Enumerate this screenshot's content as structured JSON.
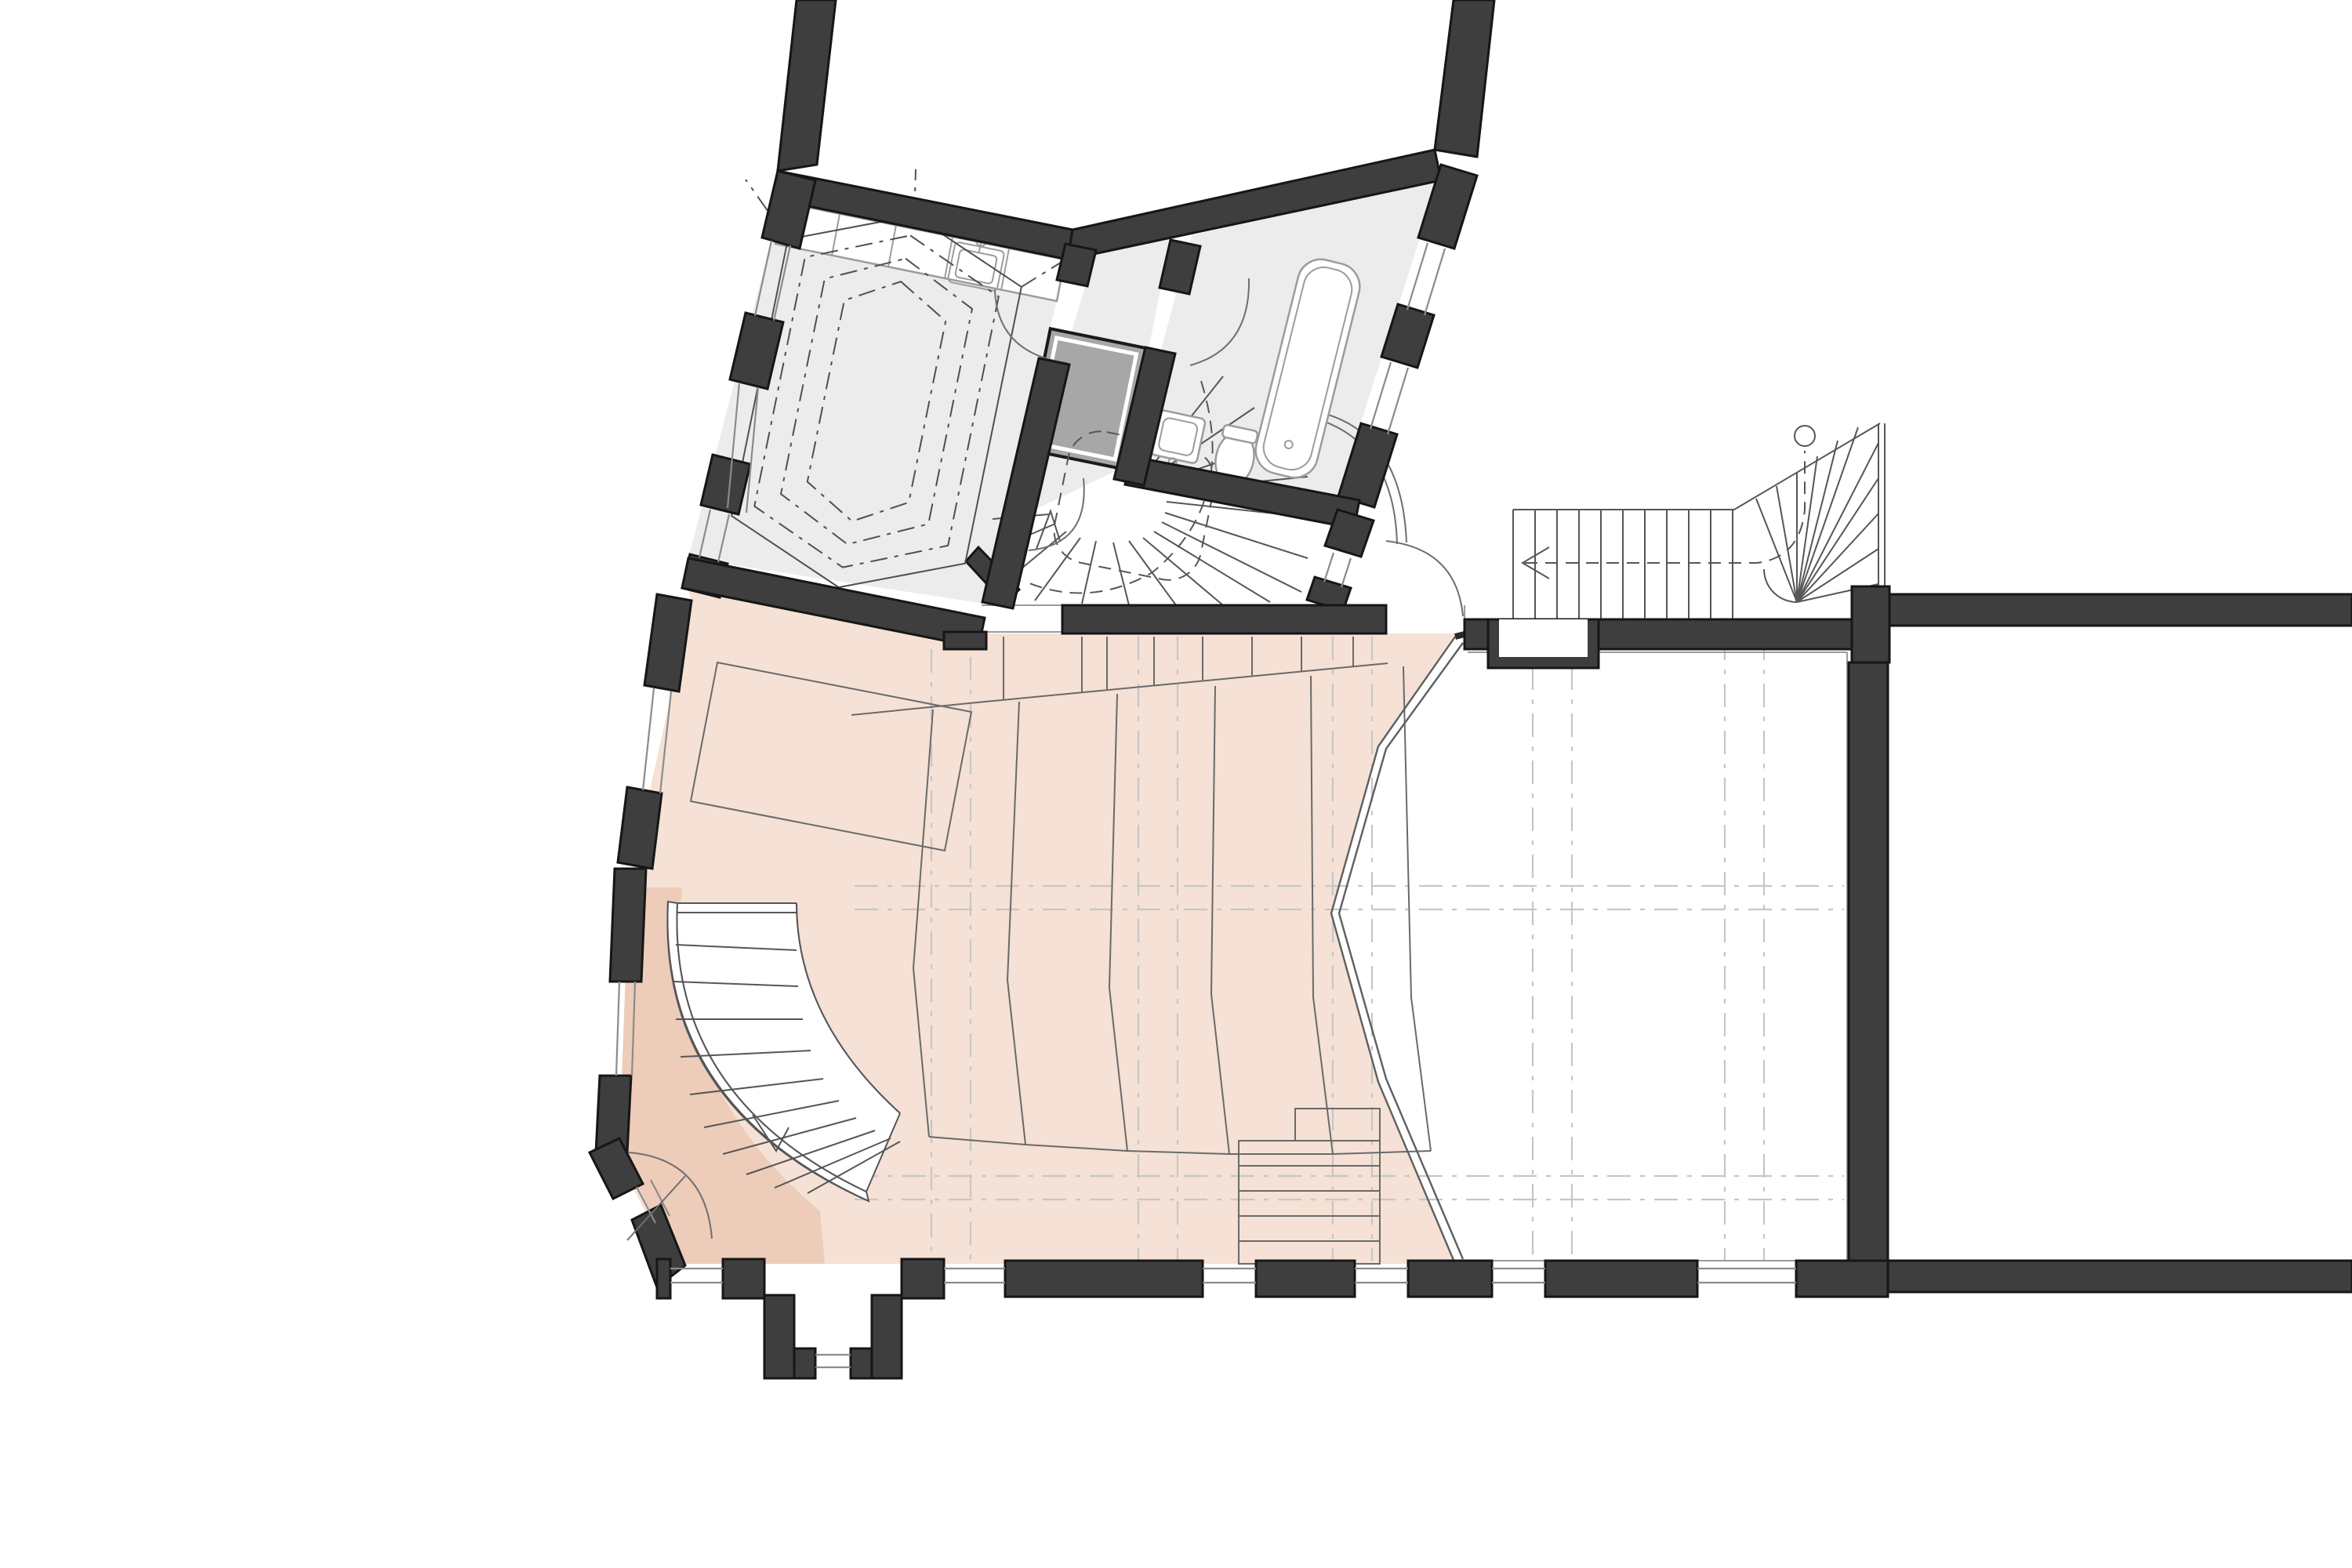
{
  "document": {
    "kind": "architectural-floor-plan",
    "visible_text": "none",
    "orientation": "upper-left wing rotated, main hall orthogonal"
  },
  "colors": {
    "background": "#ffffff",
    "wall": "#3e3e3e",
    "wallEdge": "#161616",
    "grayFloor": "#ececec",
    "peach": "#f5e1d5",
    "peachDark": "#edccb9",
    "elevator": "#a7a7a7",
    "grid": "#c6c6c6",
    "lineDark": "#5a5a5a",
    "stairLine": "#565656",
    "fixture": "#9c9c9c",
    "hexLine": "#4f4f4f"
  },
  "regions": [
    {
      "name": "attic-room-upper-left",
      "floor": "gray",
      "features": [
        "kitchenette-counter",
        "kitchen-sink",
        "dashed-vault-outline"
      ]
    },
    {
      "name": "hallway",
      "floor": "gray",
      "features": [
        "door-swings"
      ]
    },
    {
      "name": "bathroom",
      "floor": "gray",
      "features": [
        "bathtub",
        "washbasin",
        "toilet"
      ]
    },
    {
      "name": "stair-hall",
      "floor": "white",
      "features": [
        "elevator-shaft",
        "winding-stair",
        "curved-partition"
      ]
    },
    {
      "name": "auditorium-balcony",
      "floor": "peach",
      "features": [
        "seating-tiers",
        "rear-platform",
        "center-steps",
        "column-grid-dashed"
      ]
    },
    {
      "name": "side-landing-wedge",
      "floor": "peach-dark",
      "features": [
        "corner-door"
      ]
    },
    {
      "name": "main-hall",
      "floor": "white",
      "features": [
        "column-grid-dashed",
        "wall-niche",
        "balcony-front-edge"
      ]
    },
    {
      "name": "right-wing",
      "floor": "white",
      "features": [
        "straight-stair-with-winders"
      ]
    }
  ],
  "stairs": [
    {
      "name": "winding-main-stair",
      "location": "center",
      "direction_arrow": "up-left"
    },
    {
      "name": "straight-stair-right",
      "direction_arrow": "left",
      "newel_circle": true
    },
    {
      "name": "curved-side-stair",
      "location": "west",
      "direction_arrow": "down"
    }
  ],
  "fixtures": [
    "kitchen-sink",
    "bathtub",
    "washbasin",
    "toilet"
  ],
  "walls": {
    "style": "thick dark fill with black edge",
    "windows": "white gaps with thin glazing lines",
    "bay_window": "projecting at bottom center"
  }
}
